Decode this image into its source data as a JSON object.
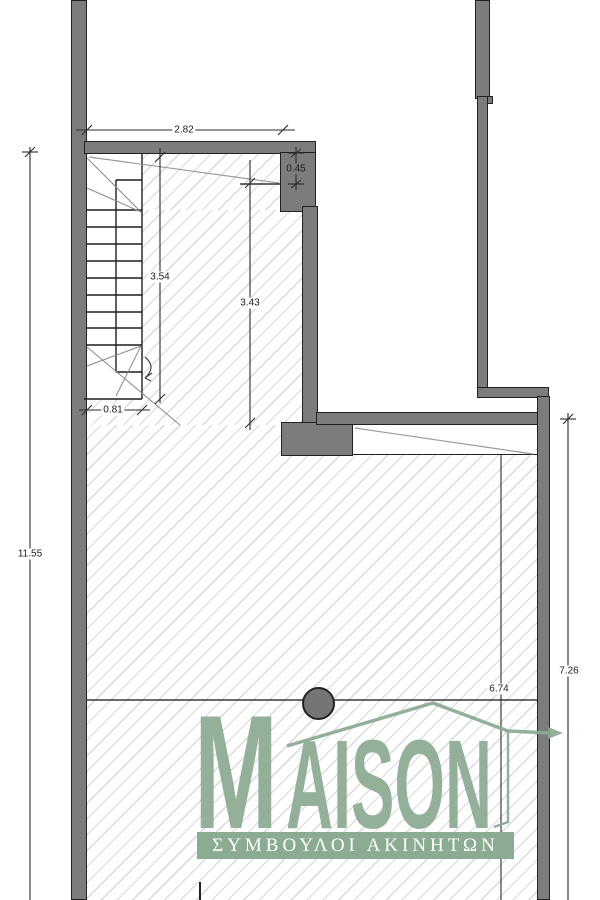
{
  "plan": {
    "type": "floor-plan",
    "dimensions": {
      "top_width": "2.82",
      "top_right_depth": "0.45",
      "stair_run_length": "3.54",
      "upper_room_length": "3.43",
      "stair_width": "0.81",
      "left_side_total": "11.55",
      "right_side_lower": "7.26",
      "lower_room_width": "6.74"
    }
  },
  "watermark": {
    "brand_initial": "M",
    "brand_rest": "AISON",
    "tagline": "ΣΥΜΒΟΥΛΟΙ ΑΚΙΝΗΤΩΝ"
  },
  "colors": {
    "wall_fill": "#7c7c7c",
    "outline": "#222222",
    "hatch": "#d9d9d9",
    "dimension_line": "#2b2b2b",
    "brand_green": "#8cab93",
    "column_fill": "#757575"
  }
}
